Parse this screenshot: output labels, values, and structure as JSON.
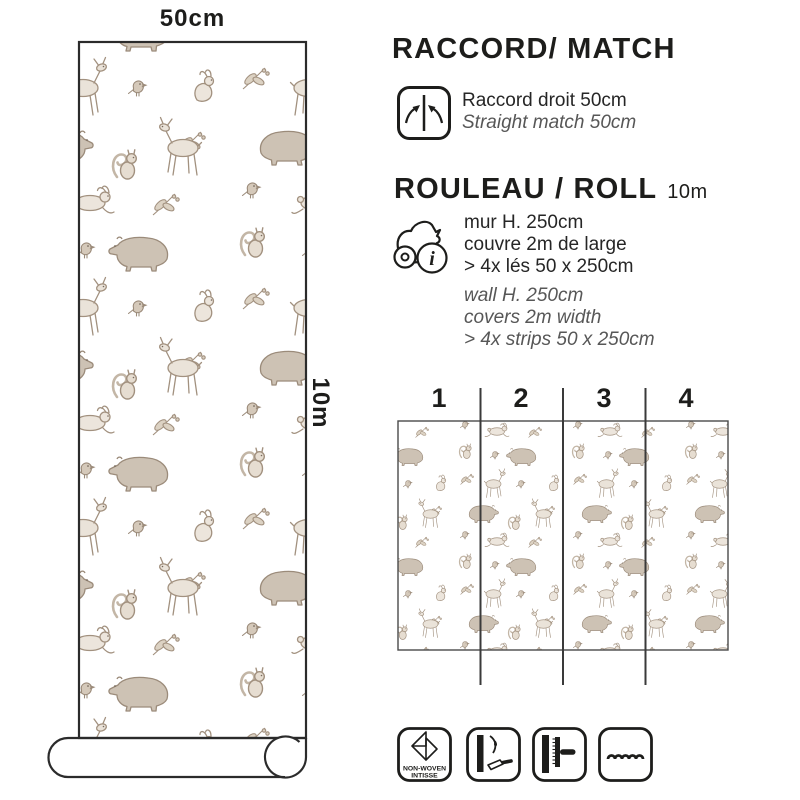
{
  "roll_preview": {
    "width_label": "50cm",
    "length_label": "10m"
  },
  "match_section": {
    "title": "RACCORD/ MATCH",
    "fr": "Raccord droit 50cm",
    "en": "Straight match 50cm"
  },
  "roll_section": {
    "title": "ROULEAU / ROLL",
    "size": "10m",
    "fr_lines": [
      "mur H. 250cm",
      "couvre 2m de large",
      "> 4x lés 50 x 250cm"
    ],
    "en_lines": [
      "wall H. 250cm",
      "covers 2m width",
      "> 4x strips 50 x 250cm"
    ]
  },
  "strips_diagram": {
    "numbers": [
      "1",
      "2",
      "3",
      "4"
    ]
  },
  "bottom_icons": {
    "non_woven_line1": "NON-WOVEN",
    "non_woven_line2": "INTISSE"
  },
  "icons": {
    "match": "straight-match-arrows-icon",
    "roll": "roll-info-icon",
    "non_woven": "non-woven-fold-icon",
    "paste": "paste-the-wall-icon",
    "smoother": "smoothing-spatula-icon",
    "wave": "wavy-line-icon"
  },
  "colors": {
    "text_primary": "#1d1d1b",
    "text_muted": "#575757",
    "pattern_stroke": "#a2917f",
    "pattern_fill": "#d6ccc0",
    "diagram_line": "#3a3a3a",
    "background": "#ffffff"
  }
}
